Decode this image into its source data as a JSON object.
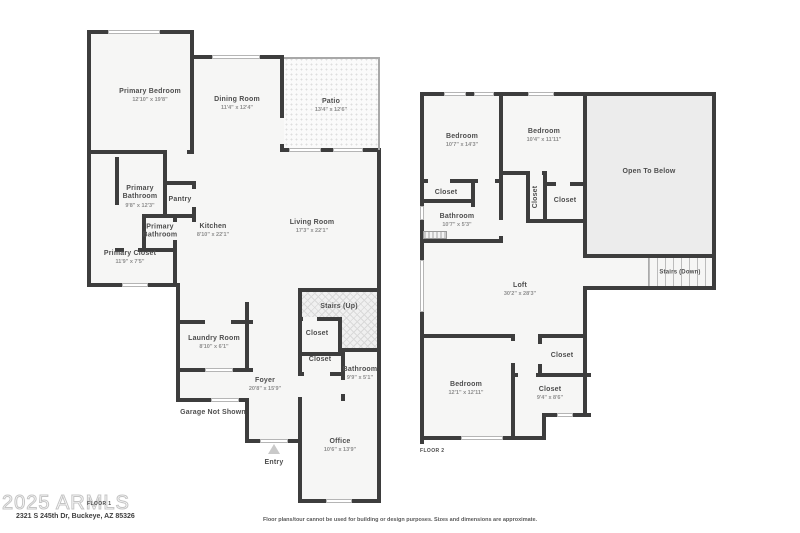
{
  "watermark": {
    "text": "2025 ARMLS"
  },
  "footer": {
    "address": "2321 S 245th Dr, Buckeye, AZ 85326",
    "disclaimer": "Floor plans/tour cannot be used for building or design purposes. Sizes and dimensions are approximate."
  },
  "colors": {
    "wall": "#3d3d3d",
    "room_fill": "#f6f6f5",
    "open_to_below_fill": "#ececec",
    "text": "#4e4e4e",
    "dims_text": "#8e8e8e"
  },
  "floor1": {
    "label": "FLOOR 1",
    "entry_label": "Entry",
    "garage_note": "Garage Not Shown",
    "rooms": {
      "primary_bedroom": {
        "name": "Primary Bedroom",
        "dims": "12'10\" x 19'8\""
      },
      "dining_room": {
        "name": "Dining Room",
        "dims": "11'4\" x 12'4\""
      },
      "patio": {
        "name": "Patio",
        "dims": "13'4\" x 12'6\""
      },
      "living_room": {
        "name": "Living Room",
        "dims": "17'3\" x 22'1\""
      },
      "kitchen": {
        "name": "Kitchen",
        "dims": "8'10\" x 22'1\""
      },
      "primary_bathroom_1": {
        "name": "Primary Bathroom",
        "dims": "9'8\" x 12'3\""
      },
      "pantry": {
        "name": "Pantry",
        "dims": ""
      },
      "primary_bathroom_2": {
        "name": "Primary Bathroom",
        "dims": ""
      },
      "primary_closet": {
        "name": "Primary Closet",
        "dims": "11'9\" x 7'5\""
      },
      "stairs_up": {
        "name": "Stairs (Up)",
        "dims": ""
      },
      "closet_1": {
        "name": "Closet",
        "dims": ""
      },
      "closet_2": {
        "name": "Closet",
        "dims": ""
      },
      "bathroom": {
        "name": "Bathroom",
        "dims": "9'9\" x 5'1\""
      },
      "laundry_room": {
        "name": "Laundry Room",
        "dims": "8'10\" x 6'1\""
      },
      "foyer": {
        "name": "Foyer",
        "dims": "20'8\" x 15'9\""
      },
      "office": {
        "name": "Office",
        "dims": "10'6\" x 13'9\""
      }
    }
  },
  "floor2": {
    "label": "FLOOR 2",
    "rooms": {
      "bedroom_1": {
        "name": "Bedroom",
        "dims": "10'7\" x 14'3\""
      },
      "bedroom_2": {
        "name": "Bedroom",
        "dims": "10'4\" x 11'11\""
      },
      "open_to_below": {
        "name": "Open To Below",
        "dims": ""
      },
      "closet_a": {
        "name": "Closet",
        "dims": ""
      },
      "bathroom": {
        "name": "Bathroom",
        "dims": "10'7\" x 5'3\""
      },
      "closet_rotated": {
        "name": "Closet",
        "dims": ""
      },
      "closet_right": {
        "name": "Closet",
        "dims": ""
      },
      "stairs_down": {
        "name": "Stairs (Down)",
        "dims": ""
      },
      "loft": {
        "name": "Loft",
        "dims": "30'2\" x 28'3\""
      },
      "bedroom_3": {
        "name": "Bedroom",
        "dims": "12'1\" x 12'11\""
      },
      "closet_c": {
        "name": "Closet",
        "dims": ""
      },
      "closet_d": {
        "name": "Closet",
        "dims": "9'4\" x 8'6\""
      }
    }
  }
}
